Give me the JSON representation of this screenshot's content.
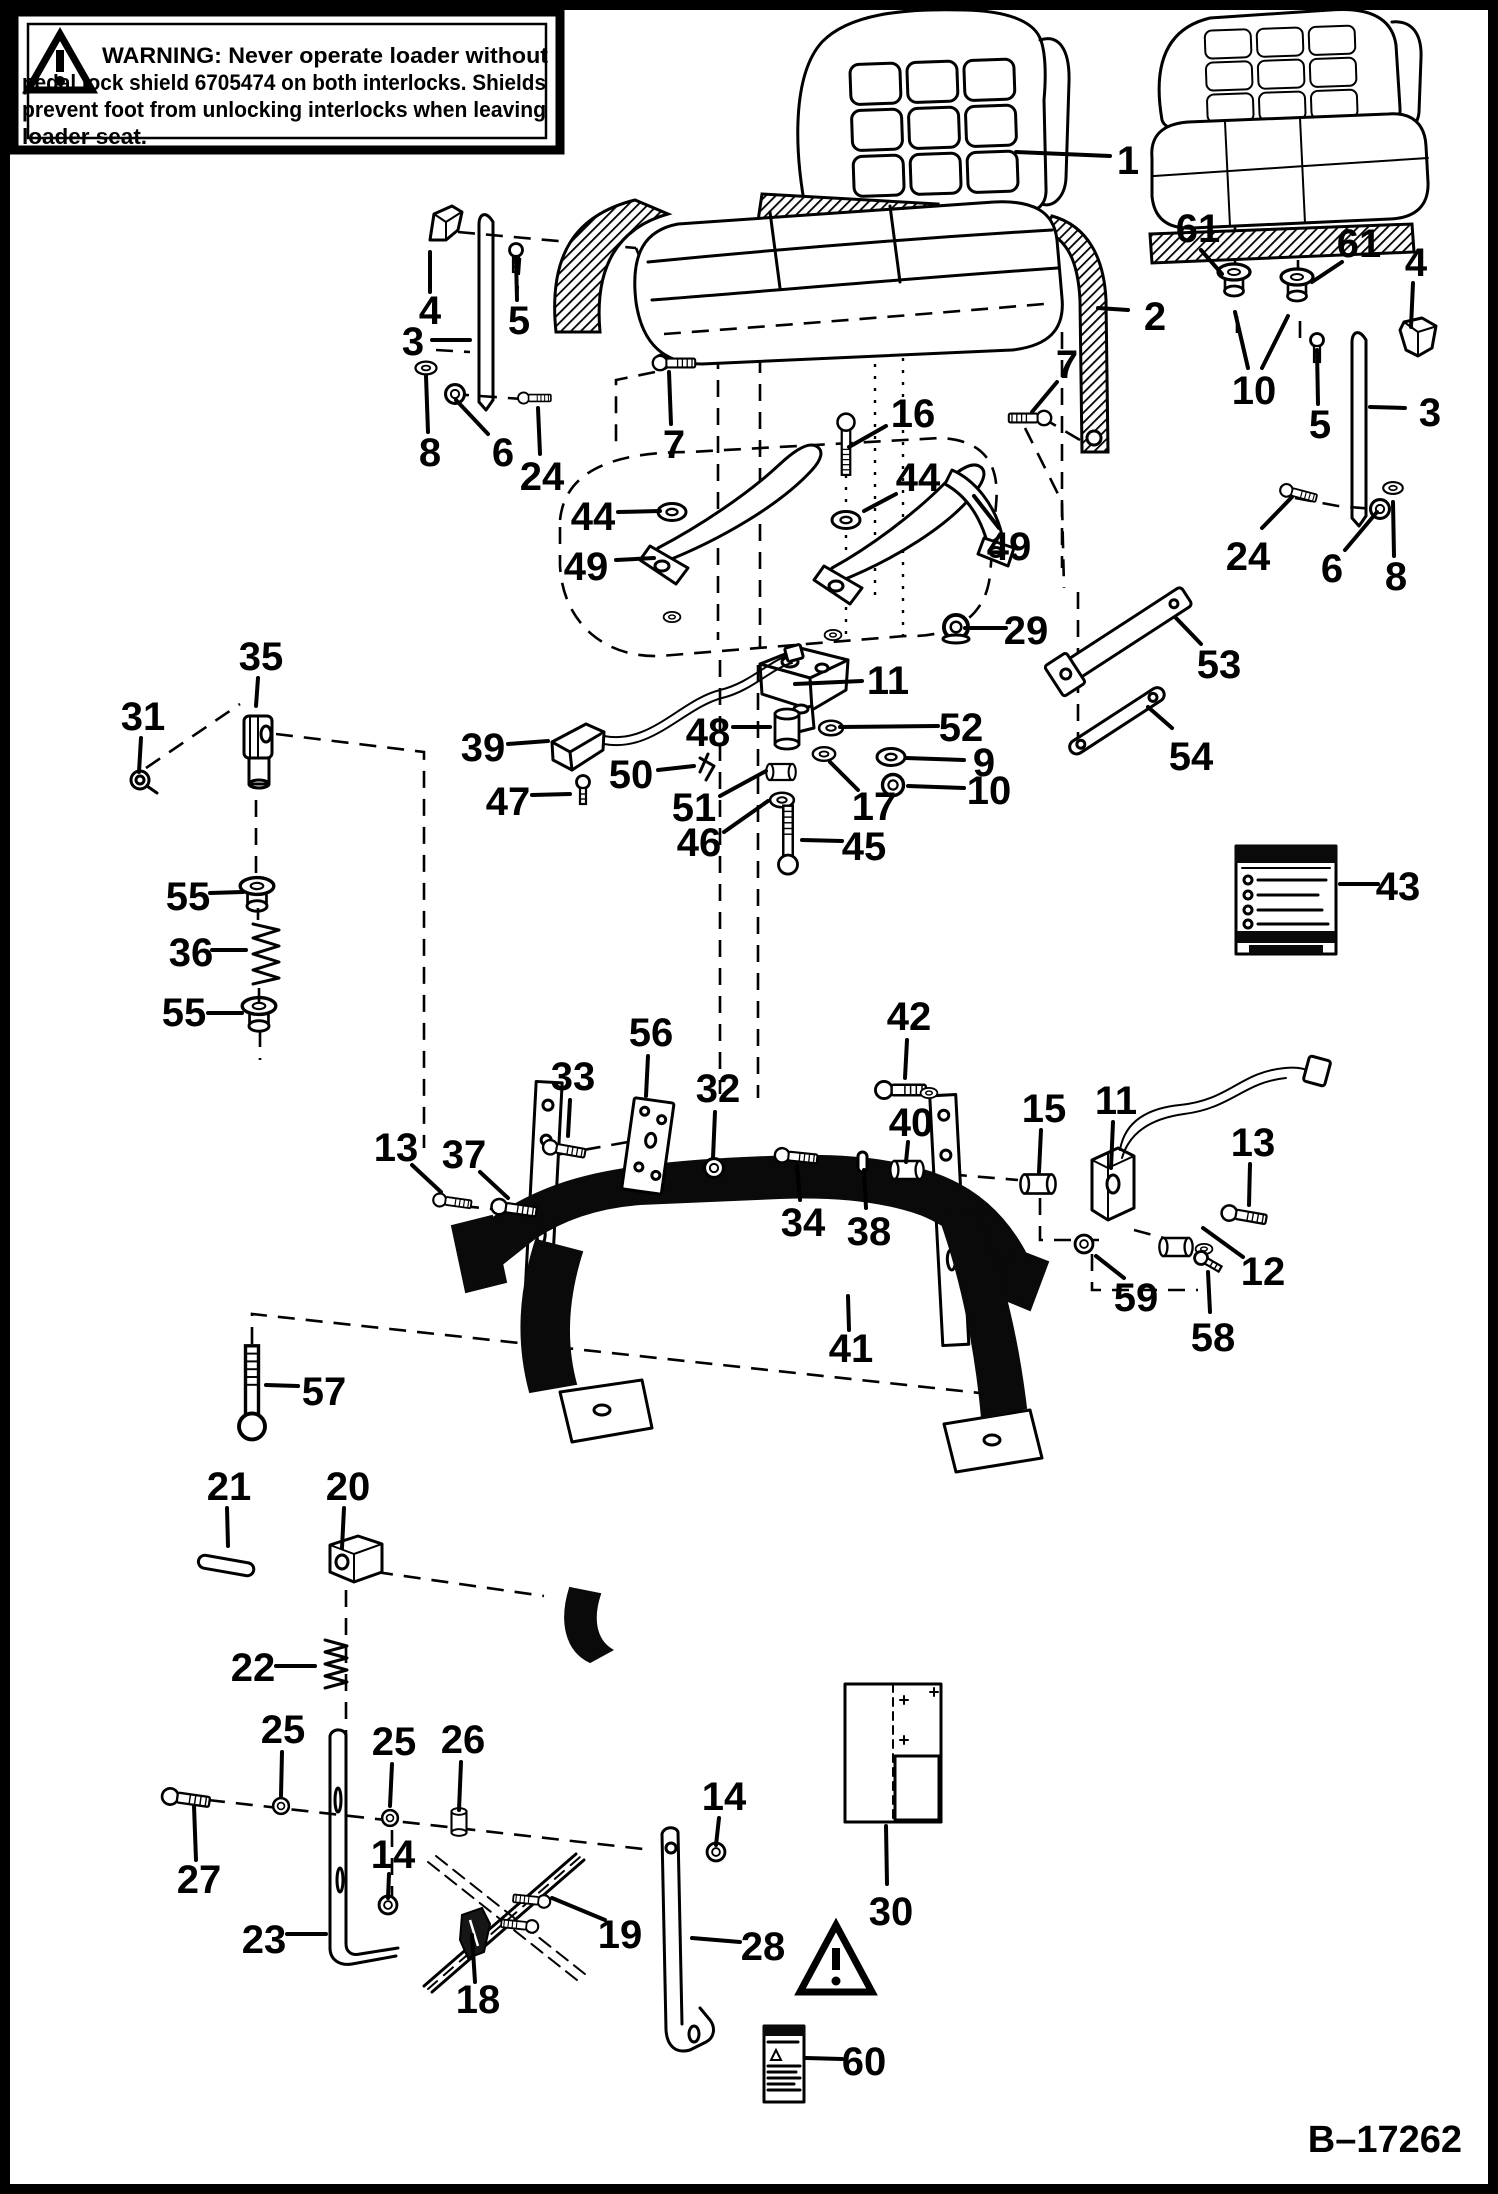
{
  "page": {
    "background": "#ffffff",
    "ink": "#000000"
  },
  "figure": {
    "id": "B–17262"
  },
  "warning_box": {
    "full_text": "WARNING: Never operate loader without pedal lock shield 6705474 on both interlocks. Shields prevent foot from unlocking interlocks when leaving loader seat.",
    "lines": [
      "WARNING:  Never operate loader without",
      "pedal lock shield 6705474 on both interlocks. Shields",
      "prevent foot from unlocking interlocks when leaving",
      "loader seat."
    ],
    "icon": "warning-triangle-icon"
  },
  "callouts": [
    {
      "part": "1",
      "x": 1128,
      "y": 174,
      "leaders": [
        [
          1110,
          156,
          1016,
          152
        ]
      ]
    },
    {
      "part": "2",
      "x": 1155,
      "y": 330,
      "leaders": [
        [
          1128,
          310,
          1098,
          308
        ]
      ]
    },
    {
      "part": "3",
      "x": 413,
      "y": 355,
      "leaders": [
        [
          432,
          340,
          470,
          340
        ]
      ]
    },
    {
      "part": "4",
      "x": 430,
      "y": 324,
      "leaders": [
        [
          430,
          292,
          430,
          252
        ]
      ]
    },
    {
      "part": "5",
      "x": 519,
      "y": 334,
      "leaders": [
        [
          517,
          300,
          516,
          258
        ]
      ]
    },
    {
      "part": "6",
      "x": 503,
      "y": 466,
      "leaders": [
        [
          488,
          434,
          456,
          400
        ]
      ]
    },
    {
      "part": "7",
      "x": 674,
      "y": 458,
      "leaders": [
        [
          671,
          424,
          669,
          372
        ]
      ]
    },
    {
      "part": "8",
      "x": 430,
      "y": 466,
      "leaders": [
        [
          428,
          432,
          426,
          376
        ]
      ]
    },
    {
      "part": "24",
      "x": 542,
      "y": 490,
      "leaders": [
        [
          540,
          454,
          538,
          408
        ]
      ]
    },
    {
      "part": "44",
      "x": 593,
      "y": 530,
      "leaders": [
        [
          618,
          512,
          660,
          511
        ]
      ]
    },
    {
      "part": "49",
      "x": 586,
      "y": 580,
      "leaders": [
        [
          616,
          560,
          654,
          558
        ]
      ]
    },
    {
      "part": "16",
      "x": 913,
      "y": 427,
      "leaders": [
        [
          886,
          426,
          849,
          447
        ]
      ]
    },
    {
      "part": "7",
      "x": 1067,
      "y": 378,
      "leaders": [
        [
          1057,
          382,
          1032,
          412
        ]
      ]
    },
    {
      "part": "61",
      "x": 1198,
      "y": 242,
      "leaders": [
        [
          1201,
          250,
          1222,
          274
        ]
      ]
    },
    {
      "part": "61",
      "x": 1359,
      "y": 257,
      "leaders": [
        [
          1342,
          262,
          1312,
          282
        ]
      ]
    },
    {
      "part": "4",
      "x": 1416,
      "y": 276,
      "leaders": [
        [
          1413,
          283,
          1411,
          327
        ]
      ]
    },
    {
      "part": "10",
      "x": 1254,
      "y": 404,
      "leaders": [
        [
          1248,
          368,
          1235,
          312
        ],
        [
          1262,
          368,
          1288,
          316
        ]
      ]
    },
    {
      "part": "5",
      "x": 1320,
      "y": 438,
      "leaders": [
        [
          1318,
          404,
          1317,
          350
        ]
      ]
    },
    {
      "part": "3",
      "x": 1430,
      "y": 426,
      "leaders": [
        [
          1405,
          408,
          1370,
          407
        ]
      ]
    },
    {
      "part": "24",
      "x": 1248,
      "y": 570,
      "leaders": [
        [
          1262,
          528,
          1292,
          497
        ]
      ]
    },
    {
      "part": "6",
      "x": 1332,
      "y": 582,
      "leaders": [
        [
          1345,
          550,
          1377,
          512
        ]
      ]
    },
    {
      "part": "8",
      "x": 1396,
      "y": 590,
      "leaders": [
        [
          1394,
          556,
          1393,
          502
        ]
      ]
    },
    {
      "part": "44",
      "x": 918,
      "y": 491,
      "leaders": [
        [
          896,
          494,
          864,
          511
        ]
      ]
    },
    {
      "part": "49",
      "x": 1009,
      "y": 560,
      "leaders": [
        [
          999,
          528,
          974,
          496
        ]
      ]
    },
    {
      "part": "29",
      "x": 1026,
      "y": 644,
      "leaders": [
        [
          1006,
          628,
          965,
          628
        ]
      ]
    },
    {
      "part": "53",
      "x": 1219,
      "y": 678,
      "leaders": [
        [
          1201,
          644,
          1176,
          618
        ]
      ]
    },
    {
      "part": "54",
      "x": 1191,
      "y": 770,
      "leaders": [
        [
          1172,
          728,
          1148,
          707
        ]
      ]
    },
    {
      "part": "43",
      "x": 1398,
      "y": 900,
      "leaders": [
        [
          1378,
          884,
          1340,
          884
        ]
      ]
    },
    {
      "part": "11",
      "x": 888,
      "y": 694,
      "leaders": [
        [
          862,
          681,
          795,
          684
        ]
      ]
    },
    {
      "part": "52",
      "x": 961,
      "y": 741,
      "leaders": [
        [
          938,
          726,
          840,
          727
        ]
      ]
    },
    {
      "part": "48",
      "x": 708,
      "y": 746,
      "leaders": [
        [
          733,
          727,
          770,
          727
        ]
      ]
    },
    {
      "part": "9",
      "x": 984,
      "y": 776,
      "leaders": [
        [
          964,
          760,
          906,
          758
        ]
      ]
    },
    {
      "part": "10",
      "x": 989,
      "y": 804,
      "leaders": [
        [
          964,
          788,
          908,
          786
        ]
      ]
    },
    {
      "part": "39",
      "x": 483,
      "y": 761,
      "leaders": [
        [
          508,
          744,
          548,
          741
        ]
      ]
    },
    {
      "part": "50",
      "x": 631,
      "y": 788,
      "leaders": [
        [
          658,
          770,
          694,
          766
        ]
      ]
    },
    {
      "part": "17",
      "x": 874,
      "y": 820,
      "leaders": [
        [
          858,
          790,
          830,
          762
        ]
      ]
    },
    {
      "part": "47",
      "x": 508,
      "y": 815,
      "leaders": [
        [
          532,
          795,
          570,
          794
        ]
      ]
    },
    {
      "part": "51",
      "x": 694,
      "y": 821,
      "leaders": [
        [
          720,
          796,
          766,
          771
        ]
      ]
    },
    {
      "part": "46",
      "x": 699,
      "y": 856,
      "leaders": [
        [
          724,
          832,
          768,
          801
        ]
      ]
    },
    {
      "part": "45",
      "x": 864,
      "y": 860,
      "leaders": [
        [
          842,
          841,
          802,
          840
        ]
      ]
    },
    {
      "part": "35",
      "x": 261,
      "y": 670,
      "leaders": [
        [
          258,
          678,
          256,
          706
        ]
      ]
    },
    {
      "part": "31",
      "x": 143,
      "y": 730,
      "leaders": [
        [
          141,
          738,
          139,
          772
        ]
      ]
    },
    {
      "part": "55",
      "x": 188,
      "y": 910,
      "leaders": [
        [
          210,
          893,
          243,
          892
        ]
      ]
    },
    {
      "part": "36",
      "x": 191,
      "y": 966,
      "leaders": [
        [
          212,
          950,
          246,
          950
        ]
      ]
    },
    {
      "part": "55",
      "x": 184,
      "y": 1026,
      "leaders": [
        [
          208,
          1013,
          242,
          1013
        ]
      ]
    },
    {
      "part": "56",
      "x": 651,
      "y": 1046,
      "leaders": [
        [
          648,
          1056,
          646,
          1096
        ]
      ]
    },
    {
      "part": "33",
      "x": 573,
      "y": 1090,
      "leaders": [
        [
          570,
          1100,
          568,
          1136
        ]
      ]
    },
    {
      "part": "32",
      "x": 718,
      "y": 1102,
      "leaders": [
        [
          715,
          1112,
          713,
          1158
        ]
      ]
    },
    {
      "part": "42",
      "x": 909,
      "y": 1030,
      "leaders": [
        [
          907,
          1040,
          905,
          1078
        ]
      ]
    },
    {
      "part": "40",
      "x": 911,
      "y": 1136,
      "leaders": [
        [
          908,
          1142,
          906,
          1162
        ]
      ]
    },
    {
      "part": "13",
      "x": 396,
      "y": 1161,
      "leaders": [
        [
          412,
          1165,
          441,
          1192
        ]
      ]
    },
    {
      "part": "37",
      "x": 464,
      "y": 1168,
      "leaders": [
        [
          480,
          1172,
          508,
          1198
        ]
      ]
    },
    {
      "part": "15",
      "x": 1044,
      "y": 1122,
      "leaders": [
        [
          1041,
          1130,
          1039,
          1172
        ]
      ]
    },
    {
      "part": "11",
      "x": 1116,
      "y": 1114,
      "leaders": [
        [
          1113,
          1122,
          1111,
          1168
        ]
      ]
    },
    {
      "part": "13",
      "x": 1253,
      "y": 1156,
      "leaders": [
        [
          1250,
          1164,
          1249,
          1205
        ]
      ]
    },
    {
      "part": "34",
      "x": 803,
      "y": 1236,
      "leaders": [
        [
          800,
          1200,
          797,
          1166
        ]
      ]
    },
    {
      "part": "38",
      "x": 869,
      "y": 1245,
      "leaders": [
        [
          866,
          1208,
          864,
          1170
        ]
      ]
    },
    {
      "part": "59",
      "x": 1136,
      "y": 1311,
      "leaders": [
        [
          1124,
          1278,
          1096,
          1256
        ]
      ]
    },
    {
      "part": "12",
      "x": 1263,
      "y": 1285,
      "leaders": [
        [
          1243,
          1257,
          1203,
          1228
        ]
      ]
    },
    {
      "part": "58",
      "x": 1213,
      "y": 1351,
      "leaders": [
        [
          1210,
          1312,
          1208,
          1272
        ]
      ]
    },
    {
      "part": "41",
      "x": 851,
      "y": 1362,
      "leaders": [
        [
          849,
          1330,
          848,
          1296
        ]
      ]
    },
    {
      "part": "57",
      "x": 324,
      "y": 1405,
      "leaders": [
        [
          298,
          1386,
          266,
          1385
        ]
      ]
    },
    {
      "part": "21",
      "x": 229,
      "y": 1500,
      "leaders": [
        [
          227,
          1508,
          228,
          1546
        ]
      ]
    },
    {
      "part": "20",
      "x": 348,
      "y": 1500,
      "leaders": [
        [
          344,
          1508,
          342,
          1548
        ]
      ]
    },
    {
      "part": "22",
      "x": 253,
      "y": 1681,
      "leaders": [
        [
          276,
          1666,
          315,
          1666
        ]
      ]
    },
    {
      "part": "25",
      "x": 283,
      "y": 1743,
      "leaders": [
        [
          282,
          1752,
          281,
          1796
        ]
      ]
    },
    {
      "part": "25",
      "x": 394,
      "y": 1755,
      "leaders": [
        [
          392,
          1764,
          390,
          1806
        ]
      ]
    },
    {
      "part": "26",
      "x": 463,
      "y": 1753,
      "leaders": [
        [
          461,
          1762,
          459,
          1810
        ]
      ]
    },
    {
      "part": "14",
      "x": 393,
      "y": 1868,
      "leaders": [
        [
          389,
          1874,
          388,
          1898
        ]
      ]
    },
    {
      "part": "27",
      "x": 199,
      "y": 1893,
      "leaders": [
        [
          196,
          1860,
          194,
          1806
        ]
      ]
    },
    {
      "part": "23",
      "x": 264,
      "y": 1953,
      "leaders": [
        [
          287,
          1934,
          326,
          1934
        ]
      ]
    },
    {
      "part": "14",
      "x": 724,
      "y": 1810,
      "leaders": [
        [
          719,
          1818,
          716,
          1845
        ]
      ]
    },
    {
      "part": "18",
      "x": 478,
      "y": 2013,
      "leaders": [
        [
          475,
          1982,
          472,
          1935
        ]
      ]
    },
    {
      "part": "19",
      "x": 620,
      "y": 1948,
      "leaders": [
        [
          605,
          1920,
          552,
          1898
        ]
      ]
    },
    {
      "part": "28",
      "x": 763,
      "y": 1960,
      "leaders": [
        [
          740,
          1942,
          692,
          1938
        ]
      ]
    },
    {
      "part": "30",
      "x": 891,
      "y": 1925,
      "leaders": [
        [
          887,
          1884,
          886,
          1826
        ]
      ]
    },
    {
      "part": "60",
      "x": 864,
      "y": 2075,
      "leaders": [
        [
          842,
          2059,
          806,
          2058
        ]
      ]
    }
  ]
}
